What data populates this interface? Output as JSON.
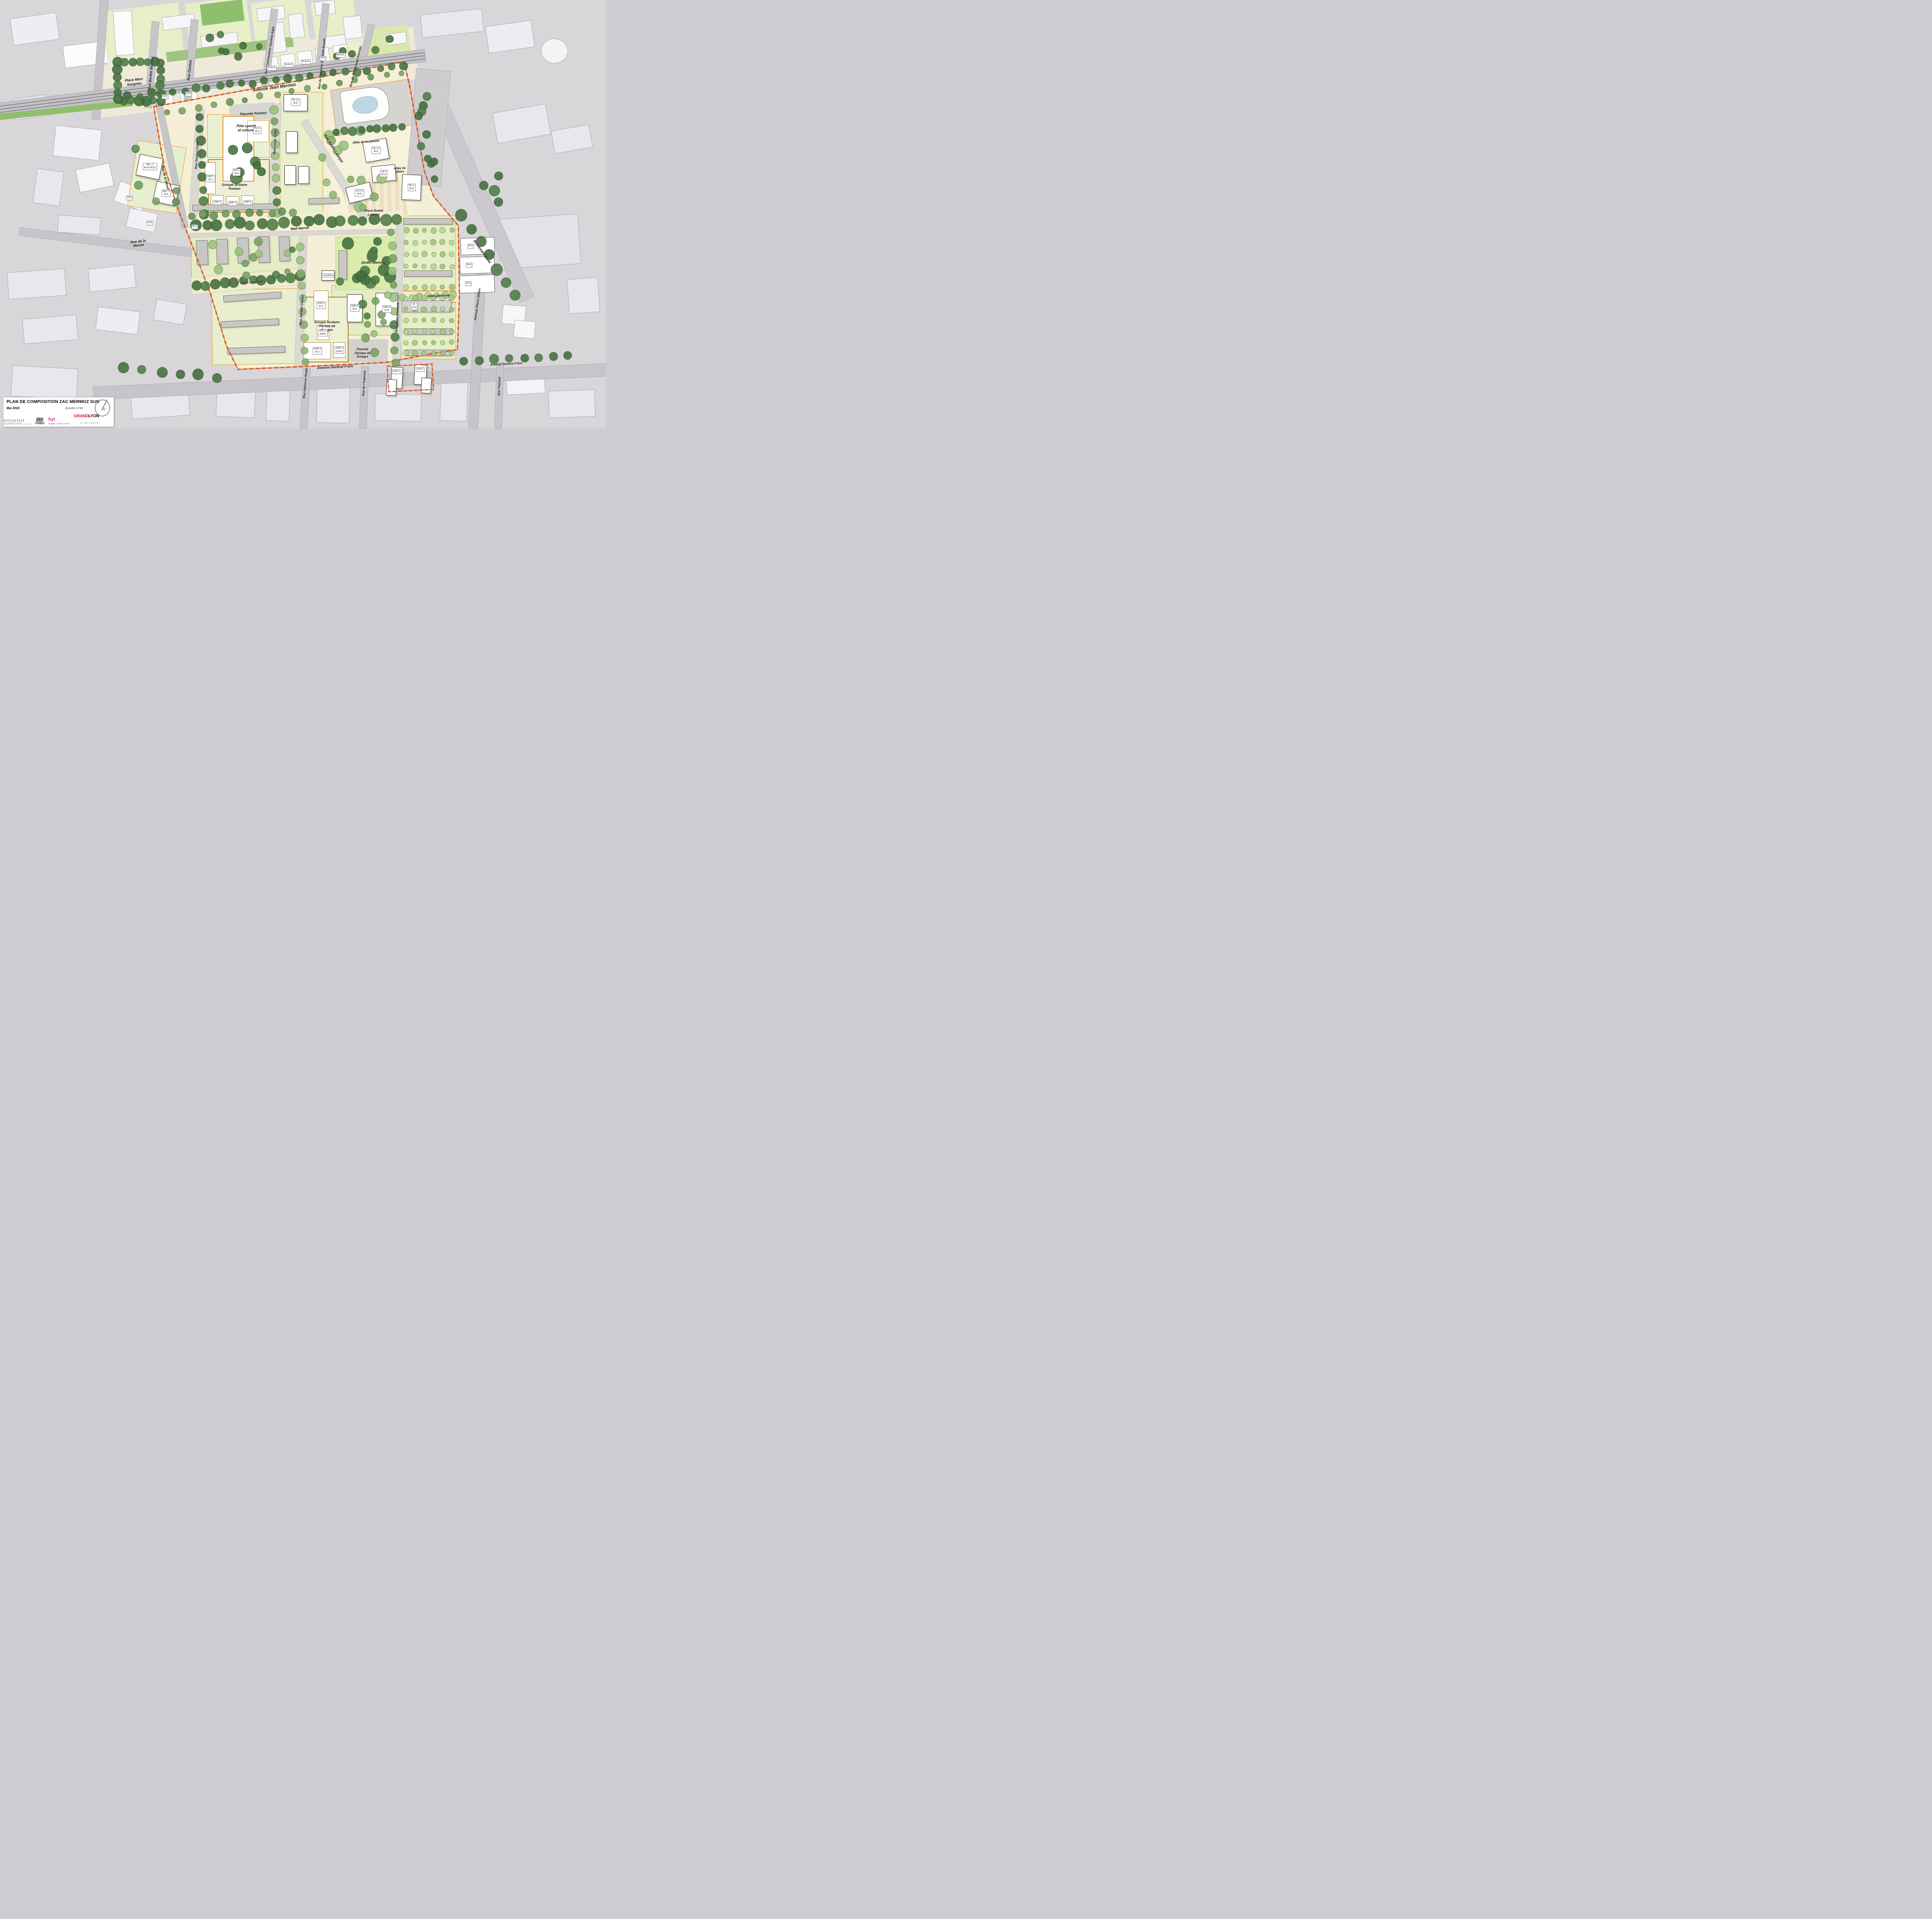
{
  "title_block": {
    "title": "PLAN DE COMPOSITION ZAC MERMOZ SUD",
    "date": "Mai 2023",
    "scale_label": "Echelle 1/750",
    "north_label": "N",
    "logos": {
      "dumetier": "DUMETIER",
      "dumetier_sub": "DESIGN",
      "tribu": "TRIBU",
      "hyl": "hyl",
      "hyl_sub": "Paysagistes, urbanistes, architectes",
      "grandlyon_1": "GRAND",
      "grandlyon_2": "LYON",
      "grandlyon_sub": "la métropole"
    }
  },
  "colors": {
    "zac_perimeter_dash": "#c9553b",
    "lot_line_orange": "#f08c1e",
    "school_lot_line": "#a87a1e",
    "zac_ground_cream": "#f4efd6",
    "green_lot": "#e2ecc2",
    "tree_dark": "#4d7d46",
    "tree_light": "#a9c981"
  },
  "streets": {
    "jean_mermoz": "Avenue Jean Mermoz",
    "berthe_morisot": "Rue Berthe Morisot",
    "genton": "Rue Genton",
    "caroline_aigle": "Rue Commandant Caroline Aigle",
    "boselli": "Rue du Capitaine Elisabeth Boselli",
    "ranvier": "Rue du Professeur Ranvier",
    "gaston_cotte": "Rue Gaston Cotte",
    "louis_tixier": "Rue Louis Tixier",
    "andre_latarjet": "Rue André Latarjet",
    "moselle": "Rue de la Moselle",
    "meuse": "Rue de la\nMeuse",
    "mail_narvik": "Mail Narvik",
    "allee_piscine": "Allée de la piscine",
    "allee_metro": "Allée du\nMétro",
    "allee_sportive": "Allée sportive",
    "allee_pietonne": "Allée piétonne",
    "joseph_chalier": "Rue Joseph Chalier",
    "jules_froment": "Rue Jules Froment",
    "general_frere": "Avenue Général Frère",
    "general_frere_east": "Avenue Général Frère",
    "alphonse_rodet": "Rue Alphonse Rodet",
    "argonne": "Rue de l'Argonne",
    "boulevard_pinel": "Boulevard Pinel",
    "pierre_millon": "Avenue Pierre Millon",
    "thenard": "Rue Thénard"
  },
  "places": {
    "marc_sangnier": "Place Marc\nSangnier",
    "placette_pasteur": "Placette Pasteur",
    "andre_latarjet": "Place André\nLatarjet",
    "jardin_mermoz": "Jardin Mermoz",
    "placette_odg": "Placette\nOlympe de\nGouges"
  },
  "facilities": {
    "pole_sportif": "Pôle sportif\net culturel",
    "gs_pasteur": "Groupe Scolaire\nPasteur",
    "gs_odg": "Groupe Scolaire\nOlympe de\nGouges",
    "chaufferie": "Chaufferie"
  },
  "lots": {
    "psc1_top": "Psc 1\nR+2",
    "psc1_bottom": "Psc 1\nR+4",
    "gsp1": "GSP 1\nR+1",
    "gsp2": "GSP 2",
    "gsp3": "GSP 3",
    "gsp4": "GSP 4",
    "tix11": "Tix 1.1\nR+6",
    "lat11": "Lat 1.1\nR+3",
    "lat2": "Lat 2\nR+4",
    "lat12": "Lat 1.2\nR+5",
    "pin1": "Pin 1\nR+6",
    "mos2": "Mos. 2\nR+5+VETC",
    "mos3": "Mos. 3\nR+4",
    "odg5": "OdG 5\nR+4",
    "odg4": "OdG 4\nR+6",
    "gso1": "GSO 1\nR+2",
    "gso1_preau": "GSO 1\npréau",
    "gso2_preau": "GSO 2\npreau",
    "gso3": "GSO 3\nR+2",
    "e_r4": "E\nR+4",
    "gnf1": "GnF 1",
    "gnf2": "GnF 2",
    "nord_r6a": "R+6",
    "nord_r6b": "R+6",
    "nord_r44a": "R+4+A",
    "nord_r44b": "R+4+A",
    "nord_r44c": "R+4+A",
    "nord_r5": "R+5",
    "nord_r55a": "R+5+A",
    "east_r5": "R+5",
    "east_r4a": "R+4",
    "east_r4b": "R+4",
    "west_r5a": "R+5",
    "west_r5b": "R+5",
    "west_r1": "R+1"
  }
}
